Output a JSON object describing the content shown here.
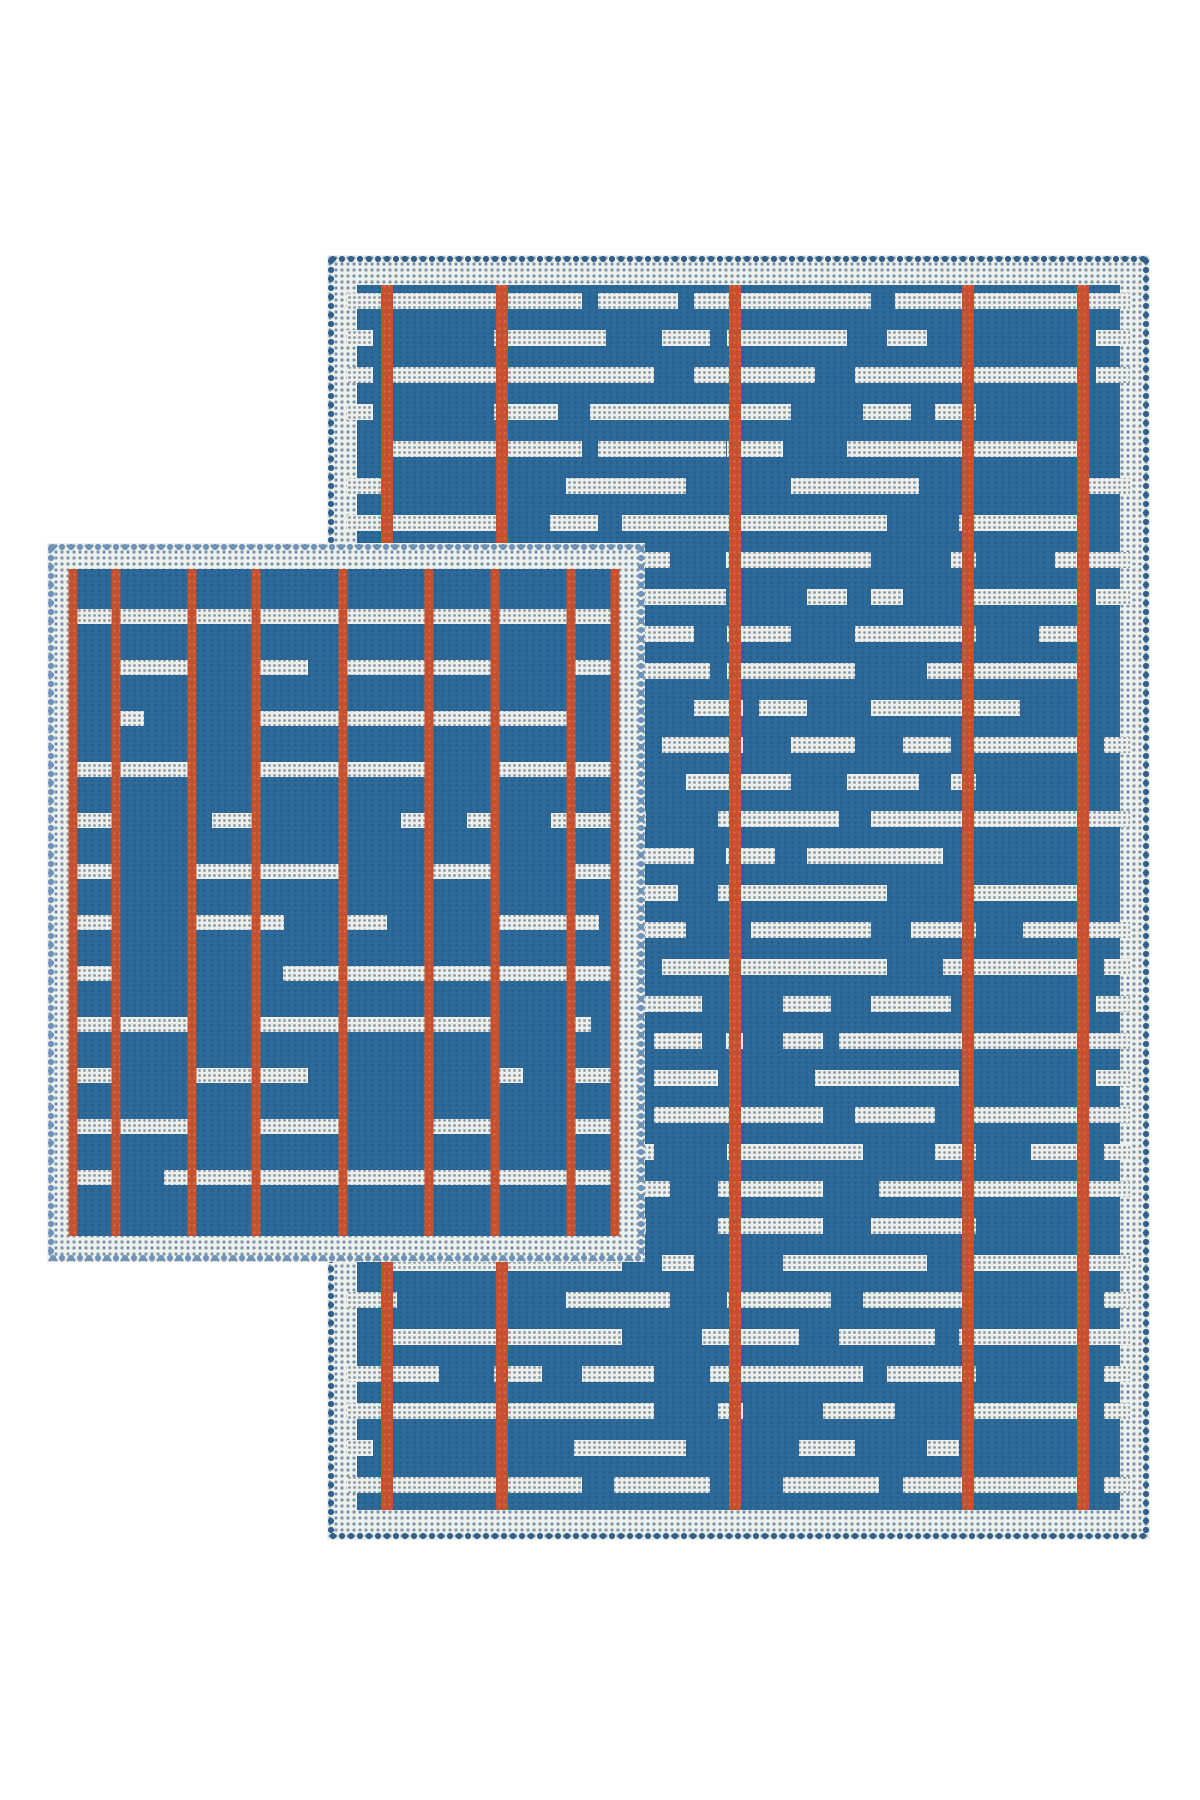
{
  "scene": {
    "background_color": "#ffffff",
    "canvas": {
      "width": 1200,
      "height": 1800
    }
  },
  "colors": {
    "background": "#ffffff",
    "ground_blue": "#2d6a9a",
    "ground_texture": "#265f8c",
    "stripe_red": "#c5502f",
    "stripe_red_light": "#d66a42",
    "speckle_base": "#edefec",
    "speckle_dot": "#8b9aa4",
    "border_base": "#eef0ec",
    "border_dot": "#7b96aa"
  },
  "rugs": [
    {
      "id": "rug-large",
      "picot_color": "#32608a",
      "box": {
        "left": 327,
        "top": 255,
        "width": 823,
        "height": 1285
      },
      "border": {
        "picot": 8,
        "band": 22,
        "inset": 30
      },
      "pattern": {
        "style": "ladder-morse",
        "seed": 13,
        "row_offset": 8,
        "row_period": 37,
        "dash_height": 16,
        "stripe_width": 12,
        "stripes_x": [
          60,
          175,
          408,
          641,
          756
        ],
        "ladder_zones": [
          1,
          4
        ]
      }
    },
    {
      "id": "rug-small",
      "picot_color": "#6d94b8",
      "box": {
        "left": 47,
        "top": 543,
        "width": 598,
        "height": 719
      },
      "border": {
        "picot": 8,
        "band": 18,
        "inset": 26
      },
      "pattern": {
        "style": "plaid-cells",
        "seed": 5,
        "row_offset": 40,
        "row_period": 51,
        "dash_height": 15,
        "stripe_width": 9,
        "stripes_x": [
          26,
          69,
          145,
          209,
          296,
          382,
          448,
          524,
          568
        ]
      }
    }
  ]
}
